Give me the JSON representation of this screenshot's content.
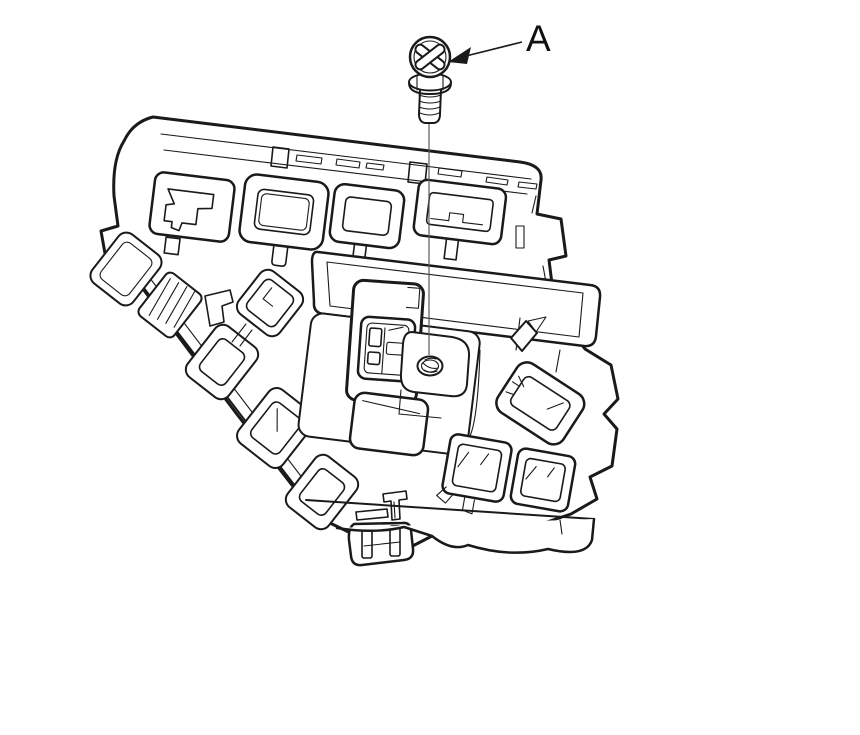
{
  "figure": {
    "callout_label": "A",
    "subject": "fuse-relay-box-with-mounting-screw",
    "colors": {
      "background": "#ffffff",
      "line": "#1a1a1a",
      "leader_line": "#5a5a5a"
    }
  }
}
